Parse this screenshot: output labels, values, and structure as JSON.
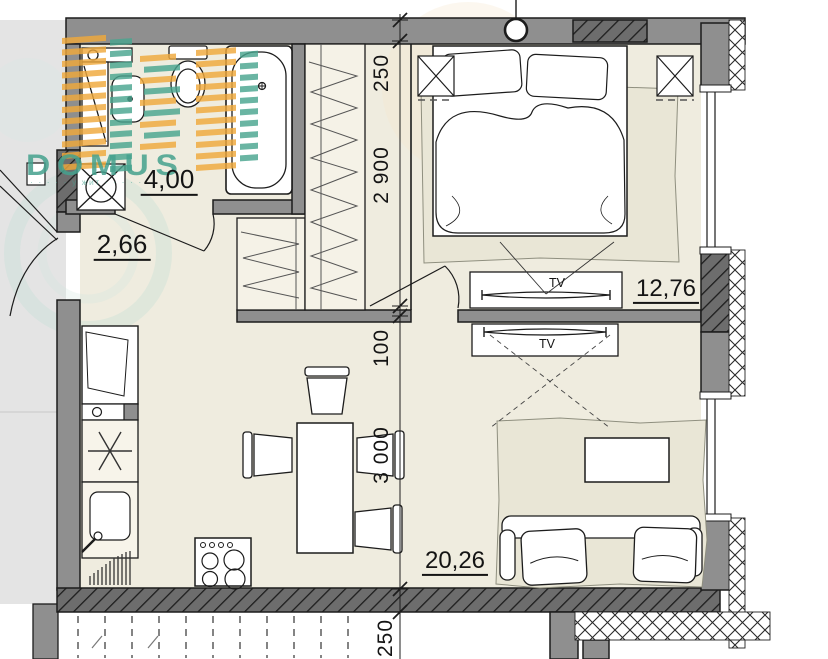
{
  "logo": {
    "name": "DOMUS",
    "tagline": "· · · · ·  у жит · · · · ·",
    "teal": "#4aa08c",
    "orange": "#f0a93c"
  },
  "rooms": [
    {
      "name": "bathroom",
      "area_label": "4,00"
    },
    {
      "name": "hallway",
      "area_label": "2,66"
    },
    {
      "name": "bedroom",
      "area_label": "12,76"
    },
    {
      "name": "living_kitchen",
      "area_label": "20,26"
    }
  ],
  "dimensions": {
    "vertical_chain": [
      "250",
      "2 900",
      "100",
      "3 000",
      "250"
    ]
  },
  "furniture_labels": {
    "tv_bedroom": "TV",
    "tv_living": "TV"
  },
  "colors": {
    "wall": "#8f8f8f",
    "dark_wall_hatch": "#6d6d6d",
    "floor": "#efecdf",
    "corridor": "#e4e4e4",
    "line": "#1c1c1c"
  }
}
